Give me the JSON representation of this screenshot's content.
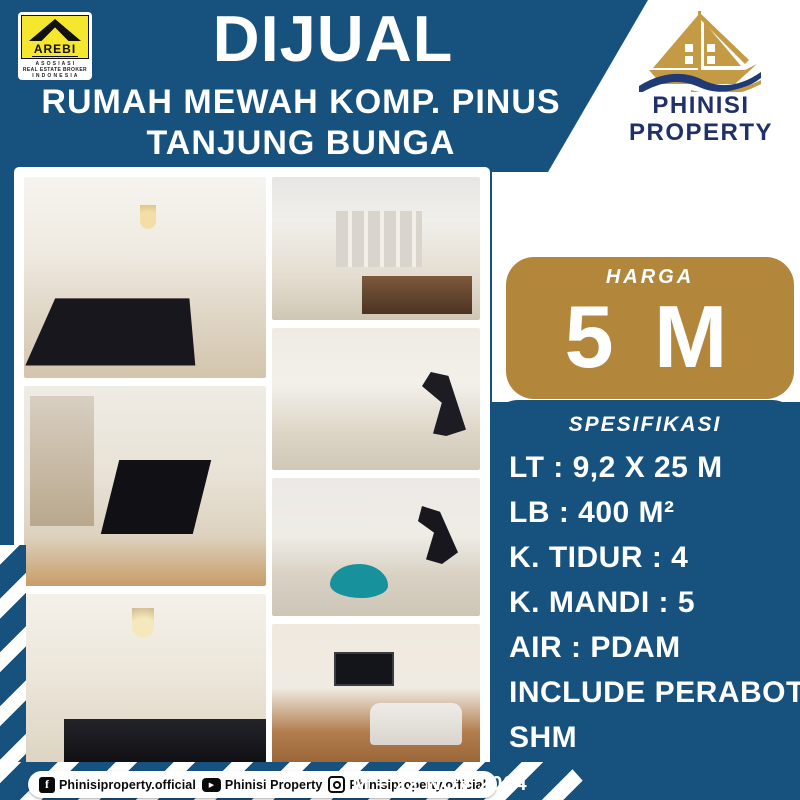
{
  "colors": {
    "background_blue": "#17527f",
    "price_badge_gold": "#b2873b",
    "brand_navy": "#1f3168",
    "arebi_yellow": "#f5e62e",
    "panel_white": "#ffffff"
  },
  "header": {
    "arebi_logo": {
      "name": "AREBI",
      "sub_line1": "A S O S I A S I",
      "sub_line2": "REAL ESTATE BROKER",
      "sub_line3": "I N D O N E S I A"
    },
    "title": "DIJUAL",
    "subtitle_line1": "RUMAH MEWAH KOMP. PINUS",
    "subtitle_line2": "TANJUNG BUNGA",
    "brand": {
      "logo_icon": "phinisi-boat-icon",
      "name_line1": "PHINISI",
      "name_line2": "PROPERTY"
    }
  },
  "price": {
    "label": "HARGA",
    "value": "5 M"
  },
  "specs": {
    "title": "SPESIFIKASI",
    "items": [
      "LT : 9,2 X 25 M",
      "LB : 400 M²",
      "K. TIDUR : 4",
      "K. MANDI : 5",
      "AIR : PDAM",
      "INCLUDE PERABOT",
      "SHM"
    ]
  },
  "photos": [
    {
      "label": "dining room with long black table"
    },
    {
      "label": "mezzanine overhead view of dining area"
    },
    {
      "label": "kitchen with pendant lamps"
    },
    {
      "label": "living room with display shelves"
    },
    {
      "label": "vaulted hall with gym equipment"
    },
    {
      "label": "upstairs landing with bean bag"
    },
    {
      "label": "family room with TV and sofa"
    }
  ],
  "footer": {
    "social": [
      {
        "icon": "facebook-icon",
        "glyph": "f",
        "handle": "Phinisiproperty.official"
      },
      {
        "icon": "youtube-icon",
        "glyph": "▶",
        "handle": "Phinisi Property"
      },
      {
        "icon": "instagram-icon",
        "handle": "Phinisiproperty.official"
      }
    ],
    "date_code": "IM – 22 NOV 2024"
  }
}
